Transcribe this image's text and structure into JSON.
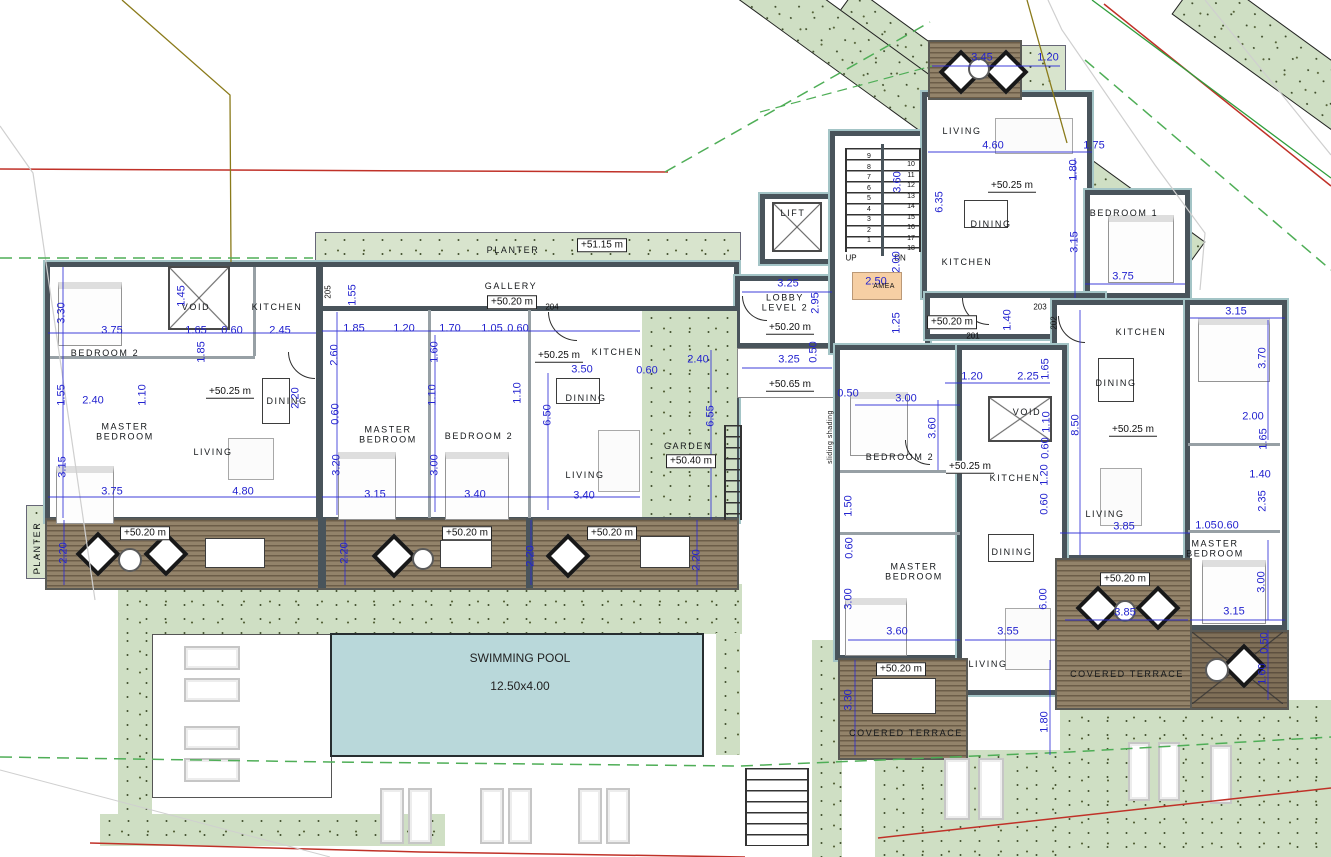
{
  "plan": {
    "pool": {
      "name": "SWIMMING POOL",
      "size": "12.50x4.00"
    },
    "stairs": {
      "up": "UP",
      "down": "DN",
      "left_numbers": "9\n8\n7\n6\n5\n4\n3\n2\n1",
      "right_numbers": "10\n11\n12\n13\n14\n15\n16\n17\n18"
    },
    "colors": {
      "dim_blue": "#2323cf",
      "wall": "#49545b",
      "grass": "#cfdfc4",
      "wood": "#8a7a62",
      "pool": "#b9d8da",
      "boundary_red": "#c03128",
      "boundary_green": "#2f9e3c",
      "amea_orange": "#f6cfa4"
    },
    "labels": {
      "rooms": [
        {
          "t": "BEDROOM 2",
          "x": 105,
          "y": 353
        },
        {
          "t": "VOID",
          "x": 196,
          "y": 307
        },
        {
          "t": "KITCHEN",
          "x": 277,
          "y": 307
        },
        {
          "t": "MASTER\nBEDROOM",
          "x": 125,
          "y": 432
        },
        {
          "t": "LIVING",
          "x": 213,
          "y": 452
        },
        {
          "t": "DINING",
          "x": 287,
          "y": 401
        },
        {
          "t": "PLANTER",
          "x": 513,
          "y": 250
        },
        {
          "t": "GALLERY",
          "x": 511,
          "y": 286
        },
        {
          "t": "MASTER\nBEDROOM",
          "x": 388,
          "y": 435
        },
        {
          "t": "BEDROOM 2",
          "x": 479,
          "y": 436
        },
        {
          "t": "KITCHEN",
          "x": 617,
          "y": 352
        },
        {
          "t": "DINING",
          "x": 586,
          "y": 398
        },
        {
          "t": "LIVING",
          "x": 585,
          "y": 475
        },
        {
          "t": "GARDEN",
          "x": 688,
          "y": 446
        },
        {
          "t": "LOBBY\nLEVEL 2",
          "x": 785,
          "y": 303
        },
        {
          "t": "LIFT",
          "x": 793,
          "y": 213
        },
        {
          "t": "LIVING",
          "x": 962,
          "y": 131
        },
        {
          "t": "DINING",
          "x": 991,
          "y": 224
        },
        {
          "t": "KITCHEN",
          "x": 967,
          "y": 262
        },
        {
          "t": "BEDROOM 1",
          "x": 1124,
          "y": 213
        },
        {
          "t": "KITCHEN",
          "x": 1141,
          "y": 332
        },
        {
          "t": "DINING",
          "x": 1116,
          "y": 383
        },
        {
          "t": "LIVING",
          "x": 1105,
          "y": 514
        },
        {
          "t": "MASTER\nBEDROOM",
          "x": 1215,
          "y": 549
        },
        {
          "t": "BEDROOM 2",
          "x": 900,
          "y": 457
        },
        {
          "t": "VOID",
          "x": 1027,
          "y": 412
        },
        {
          "t": "KITCHEN",
          "x": 1015,
          "y": 478
        },
        {
          "t": "DINING",
          "x": 1012,
          "y": 552
        },
        {
          "t": "MASTER\nBEDROOM",
          "x": 914,
          "y": 572
        },
        {
          "t": "LIVING",
          "x": 988,
          "y": 664
        },
        {
          "t": "COVERED TERRACE",
          "x": 906,
          "y": 733
        },
        {
          "t": "COVERED TERRACE",
          "x": 1127,
          "y": 674
        },
        {
          "t": "PLANTER",
          "x": 37,
          "y": 548,
          "v": 1
        }
      ],
      "small": [
        {
          "t": "AMEA",
          "x": 884,
          "y": 287
        },
        {
          "t": "sliding shading",
          "x": 831,
          "y": 437,
          "v": 1
        }
      ],
      "levels": [
        {
          "t": "+51.15 m",
          "x": 602,
          "y": 245,
          "box": 1
        },
        {
          "t": "+50.20 m",
          "x": 512,
          "y": 302,
          "box": 1
        },
        {
          "t": "+50.40 m",
          "x": 691,
          "y": 461,
          "box": 1
        },
        {
          "t": "+50.20 m",
          "x": 145,
          "y": 533,
          "box": 1
        },
        {
          "t": "+50.20 m",
          "x": 467,
          "y": 533,
          "box": 1
        },
        {
          "t": "+50.20 m",
          "x": 612,
          "y": 533,
          "box": 1
        },
        {
          "t": "+50.20 m",
          "x": 901,
          "y": 669,
          "box": 1
        },
        {
          "t": "+50.20 m",
          "x": 1125,
          "y": 579,
          "box": 1
        },
        {
          "t": "+50.20 m",
          "x": 952,
          "y": 322,
          "box": 1
        },
        {
          "t": "+50.25 m",
          "x": 230,
          "y": 392,
          "u": 1
        },
        {
          "t": "+50.25 m",
          "x": 559,
          "y": 356,
          "u": 1
        },
        {
          "t": "+50.20 m",
          "x": 790,
          "y": 328,
          "u": 1
        },
        {
          "t": "+50.65 m",
          "x": 790,
          "y": 385,
          "u": 1
        },
        {
          "t": "+50.25 m",
          "x": 1012,
          "y": 186,
          "u": 1
        },
        {
          "t": "+50.25 m",
          "x": 1133,
          "y": 430,
          "u": 1
        },
        {
          "t": "+50.25 m",
          "x": 970,
          "y": 467,
          "u": 1
        }
      ],
      "doors": [
        {
          "t": "205",
          "x": 328,
          "y": 292,
          "v": 1
        },
        {
          "t": "204",
          "x": 552,
          "y": 307
        },
        {
          "t": "201",
          "x": 973,
          "y": 336
        },
        {
          "t": "202",
          "x": 1054,
          "y": 323,
          "v": 1
        },
        {
          "t": "203",
          "x": 1040,
          "y": 307
        }
      ],
      "dims": [
        {
          "t": "3.30",
          "x": 62,
          "y": 313,
          "v": 1
        },
        {
          "t": "3.75",
          "x": 112,
          "y": 331
        },
        {
          "t": "1.45",
          "x": 182,
          "y": 296,
          "v": 1
        },
        {
          "t": "1.65",
          "x": 196,
          "y": 331
        },
        {
          "t": "0.60",
          "x": 232,
          "y": 331
        },
        {
          "t": "2.45",
          "x": 280,
          "y": 331
        },
        {
          "t": "1.55",
          "x": 62,
          "y": 395,
          "v": 1
        },
        {
          "t": "2.40",
          "x": 93,
          "y": 401
        },
        {
          "t": "1.10",
          "x": 143,
          "y": 395,
          "v": 1
        },
        {
          "t": "1.85",
          "x": 202,
          "y": 352,
          "v": 1
        },
        {
          "t": "3.15",
          "x": 63,
          "y": 467,
          "v": 1
        },
        {
          "t": "3.75",
          "x": 112,
          "y": 492
        },
        {
          "t": "4.80",
          "x": 243,
          "y": 492
        },
        {
          "t": "2.20",
          "x": 296,
          "y": 398,
          "v": 1
        },
        {
          "t": "2.60",
          "x": 335,
          "y": 355,
          "v": 1
        },
        {
          "t": "0.60",
          "x": 336,
          "y": 414,
          "v": 1
        },
        {
          "t": "1.55",
          "x": 353,
          "y": 295,
          "v": 1
        },
        {
          "t": "1.85",
          "x": 354,
          "y": 329
        },
        {
          "t": "1.20",
          "x": 404,
          "y": 329
        },
        {
          "t": "1.70",
          "x": 450,
          "y": 329
        },
        {
          "t": "1.05",
          "x": 492,
          "y": 329
        },
        {
          "t": "0.60",
          "x": 518,
          "y": 329
        },
        {
          "t": "1.60",
          "x": 435,
          "y": 352,
          "v": 1
        },
        {
          "t": "1.10",
          "x": 433,
          "y": 395,
          "v": 1
        },
        {
          "t": "1.10",
          "x": 518,
          "y": 393,
          "v": 1
        },
        {
          "t": "3.50",
          "x": 582,
          "y": 370
        },
        {
          "t": "6.50",
          "x": 548,
          "y": 415,
          "v": 1
        },
        {
          "t": "0.60",
          "x": 647,
          "y": 371
        },
        {
          "t": "3.20",
          "x": 337,
          "y": 465,
          "v": 1
        },
        {
          "t": "3.00",
          "x": 435,
          "y": 465,
          "v": 1
        },
        {
          "t": "3.15",
          "x": 375,
          "y": 495
        },
        {
          "t": "3.40",
          "x": 475,
          "y": 495
        },
        {
          "t": "3.40",
          "x": 584,
          "y": 496
        },
        {
          "t": "2.40",
          "x": 698,
          "y": 360
        },
        {
          "t": "6.55",
          "x": 711,
          "y": 416,
          "v": 1
        },
        {
          "t": "3.25",
          "x": 788,
          "y": 284
        },
        {
          "t": "2.95",
          "x": 816,
          "y": 303,
          "v": 1
        },
        {
          "t": "3.25",
          "x": 789,
          "y": 360
        },
        {
          "t": "0.50",
          "x": 814,
          "y": 352,
          "v": 1
        },
        {
          "t": "2.50",
          "x": 876,
          "y": 282
        },
        {
          "t": "2.00",
          "x": 897,
          "y": 262,
          "v": 1
        },
        {
          "t": "1.25",
          "x": 897,
          "y": 323,
          "v": 1
        },
        {
          "t": "3.60",
          "x": 898,
          "y": 182,
          "v": 1
        },
        {
          "t": "6.35",
          "x": 940,
          "y": 202,
          "v": 1
        },
        {
          "t": "1.40",
          "x": 1008,
          "y": 320,
          "v": 1
        },
        {
          "t": "3.45",
          "x": 982,
          "y": 58
        },
        {
          "t": "1.20",
          "x": 1048,
          "y": 58
        },
        {
          "t": "4.60",
          "x": 993,
          "y": 146
        },
        {
          "t": "1.75",
          "x": 1094,
          "y": 146
        },
        {
          "t": "1.80",
          "x": 1074,
          "y": 170,
          "v": 1
        },
        {
          "t": "3.15",
          "x": 1075,
          "y": 242,
          "v": 1
        },
        {
          "t": "3.75",
          "x": 1123,
          "y": 277
        },
        {
          "t": "1.20",
          "x": 972,
          "y": 377
        },
        {
          "t": "2.25",
          "x": 1028,
          "y": 377
        },
        {
          "t": "1.65",
          "x": 1046,
          "y": 369,
          "v": 1
        },
        {
          "t": "3.15",
          "x": 1236,
          "y": 312
        },
        {
          "t": "3.70",
          "x": 1263,
          "y": 358,
          "v": 1
        },
        {
          "t": "8.50",
          "x": 1076,
          "y": 425,
          "v": 1
        },
        {
          "t": "2.00",
          "x": 1253,
          "y": 417
        },
        {
          "t": "1.65",
          "x": 1264,
          "y": 439,
          "v": 1
        },
        {
          "t": "1.40",
          "x": 1260,
          "y": 475
        },
        {
          "t": "2.35",
          "x": 1263,
          "y": 501,
          "v": 1
        },
        {
          "t": "3.85",
          "x": 1124,
          "y": 527
        },
        {
          "t": "1.05",
          "x": 1206,
          "y": 526
        },
        {
          "t": "0.60",
          "x": 1228,
          "y": 526
        },
        {
          "t": "1.10",
          "x": 1047,
          "y": 422,
          "v": 1
        },
        {
          "t": "0.60",
          "x": 1046,
          "y": 448,
          "v": 1
        },
        {
          "t": "1.20",
          "x": 1045,
          "y": 475,
          "v": 1
        },
        {
          "t": "0.60",
          "x": 1045,
          "y": 504,
          "v": 1
        },
        {
          "t": "0.50",
          "x": 848,
          "y": 394
        },
        {
          "t": "3.00",
          "x": 906,
          "y": 399
        },
        {
          "t": "3.60",
          "x": 933,
          "y": 428,
          "v": 1
        },
        {
          "t": "1.50",
          "x": 849,
          "y": 506,
          "v": 1
        },
        {
          "t": "0.60",
          "x": 850,
          "y": 548,
          "v": 1
        },
        {
          "t": "3.00",
          "x": 849,
          "y": 599,
          "v": 1
        },
        {
          "t": "6.00",
          "x": 1044,
          "y": 599,
          "v": 1
        },
        {
          "t": "3.60",
          "x": 897,
          "y": 632
        },
        {
          "t": "3.55",
          "x": 1008,
          "y": 632
        },
        {
          "t": "3.30",
          "x": 849,
          "y": 700,
          "v": 1
        },
        {
          "t": "1.80",
          "x": 1045,
          "y": 722,
          "v": 1
        },
        {
          "t": "3.00",
          "x": 1262,
          "y": 582,
          "v": 1
        },
        {
          "t": "3.15",
          "x": 1234,
          "y": 612
        },
        {
          "t": "3.85",
          "x": 1125,
          "y": 613
        },
        {
          "t": "0.50",
          "x": 1265,
          "y": 643,
          "v": 1
        },
        {
          "t": "1.60",
          "x": 1263,
          "y": 674,
          "v": 1
        },
        {
          "t": "2.20",
          "x": 64,
          "y": 553,
          "v": 1
        },
        {
          "t": "2.20",
          "x": 345,
          "y": 553,
          "v": 1
        },
        {
          "t": "2.20",
          "x": 531,
          "y": 556,
          "v": 1
        },
        {
          "t": "2.20",
          "x": 697,
          "y": 560,
          "v": 1
        }
      ]
    }
  }
}
